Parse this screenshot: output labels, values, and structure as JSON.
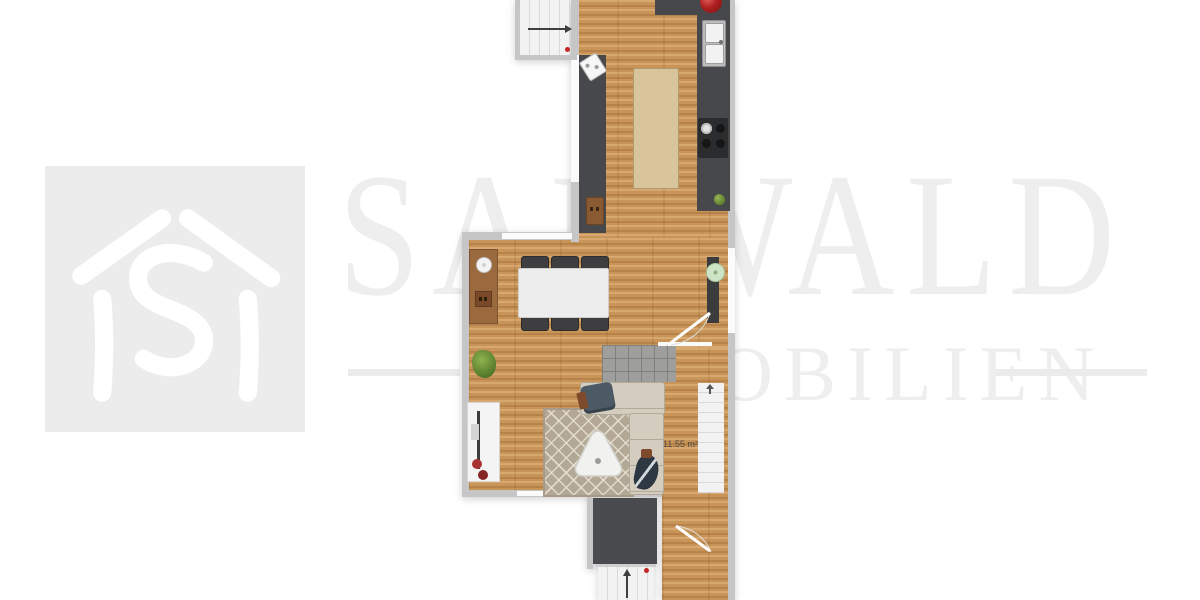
{
  "watermark": {
    "title": "SARWALD",
    "subtitle": "IMMOBILIEN",
    "logo_icon": "house-with-s-monogram"
  },
  "plan": {
    "area_label": "11.55 m²",
    "items": [
      "staircase-top",
      "kitchen-counter",
      "sink",
      "stove",
      "kitchen-island",
      "dining-table",
      "six-chairs",
      "sideboard",
      "shelf-plant",
      "entry-tiles",
      "corner-sofa",
      "rug",
      "coffee-table",
      "tv-lowboard",
      "potted-plant",
      "staircase-right",
      "staircase-bottom",
      "door-swing",
      "direction-arrows"
    ]
  },
  "colors": {
    "wood": "#c89457",
    "counter": "#46484b",
    "wall": "#c6c6c6",
    "island": "#d9c59c",
    "rug": "#b3a795",
    "sofa": "#d4cdbf",
    "accent_red": "#b02020",
    "watermark": "#eeeeee"
  }
}
